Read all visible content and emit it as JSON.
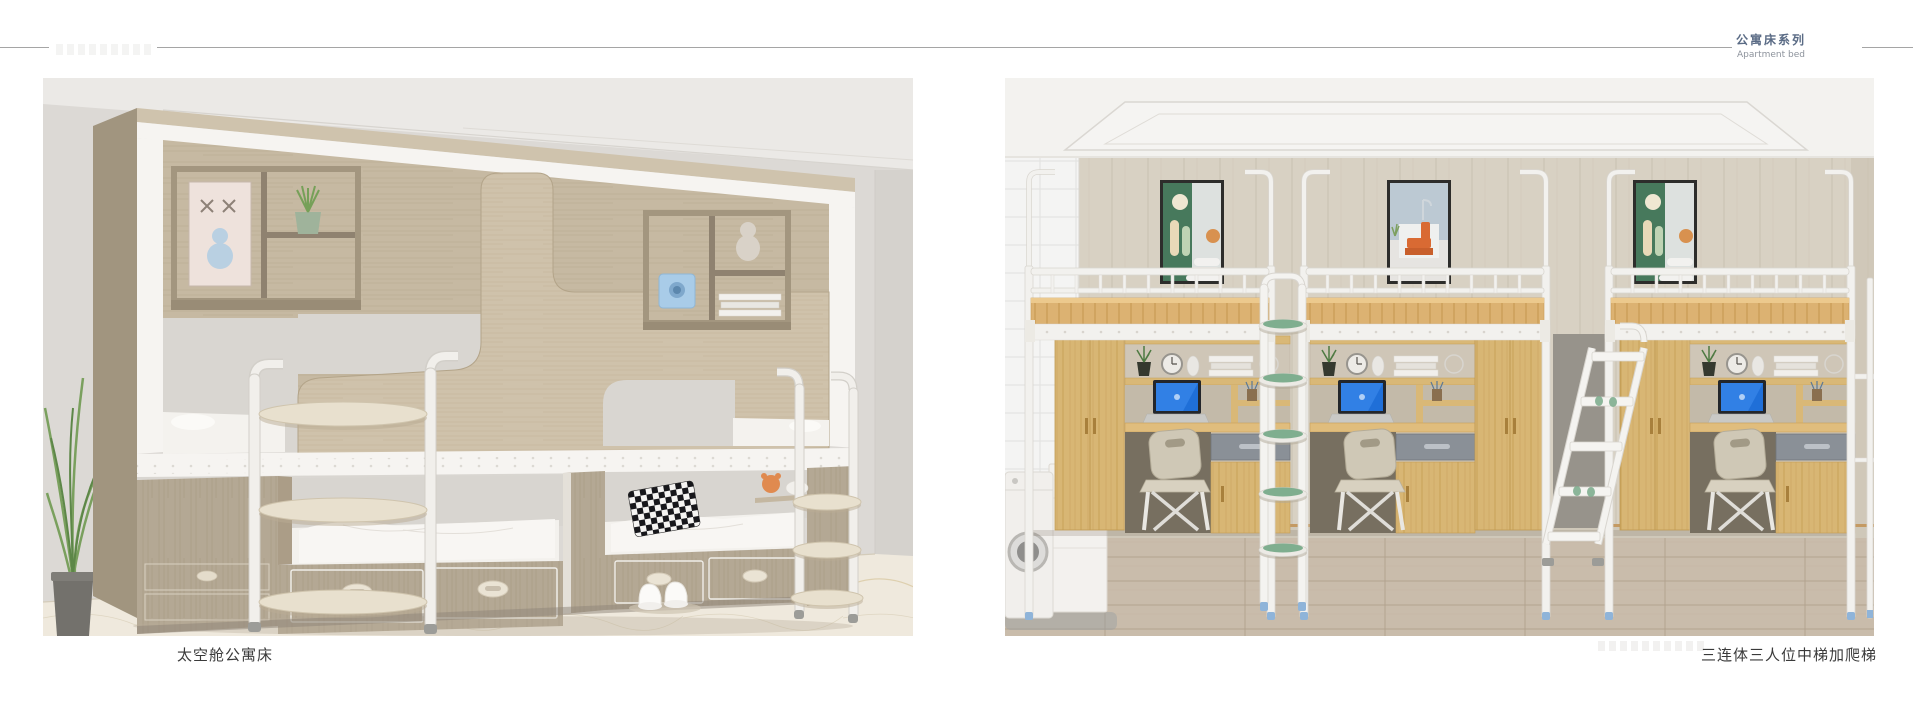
{
  "header": {
    "series_title_zh": "公寓床系列",
    "series_title_en": "Apartment bed"
  },
  "products": [
    {
      "caption": "太空舱公寓床"
    },
    {
      "caption": "三连体三人位中梯加爬梯"
    }
  ],
  "palette": {
    "title_blue": "#5a6b85",
    "subtitle_gray": "#8d939c",
    "rule_gray": "#a5a5a5",
    "caption_dark": "#3a3a3a",
    "metal_white": "#f2f1ee",
    "wood_light": "#c6b9a2",
    "wood_oak": "#d8b674",
    "wall_gray": "#dcd9d5",
    "wall_beige": "#d8d1c3",
    "floor_marble": "#efe9dd",
    "floor_wood": "#c9bcab",
    "accent_green": "#7fae8f",
    "accent_blue_screen": "#1f6fd8",
    "art_green": "#47795c",
    "art_orange": "#d96a33"
  }
}
